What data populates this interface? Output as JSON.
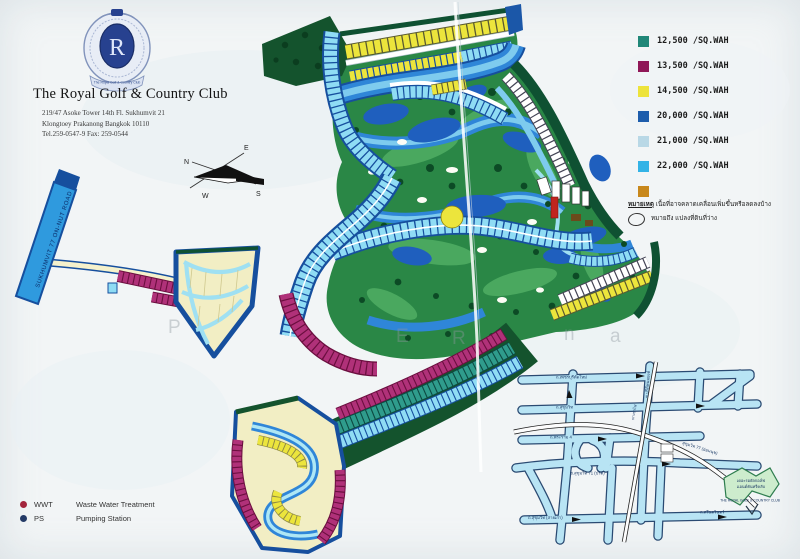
{
  "header": {
    "title": "The Royal Golf & Country Club",
    "address_line1": "219/47 Asoke Tower 14th Fl. Sukhumvit 21",
    "address_line2": "Klongtoey Prakanong Bangkok 10110",
    "address_line3": "Tel.259-0547-9 Fax: 259-0544",
    "crest_monogram": "R",
    "crest_ribbon": "The Royal Golf & Country Club"
  },
  "compass": {
    "n": "N",
    "e": "E",
    "w": "W",
    "s": "S"
  },
  "legend": {
    "items": [
      {
        "label": "12,500 /SQ.WAH",
        "color": "#208778"
      },
      {
        "label": "13,500 /SQ.WAH",
        "color": "#8f1757"
      },
      {
        "label": "14,500 /SQ.WAH",
        "color": "#ede33b"
      },
      {
        "label": "20,000 /SQ.WAH",
        "color": "#1d5dac"
      },
      {
        "label": "21,000 /SQ.WAH",
        "color": "#b9d8e6"
      },
      {
        "label": "22,000 /SQ.WAH",
        "color": "#33b3e6"
      },
      {
        "label": "",
        "color": "#c8881c"
      }
    ],
    "note_heading": "หมายเหตุ",
    "note_text": "เนื้อที่อาจคลาดเคลื่อนเพิ่มขึ้นหรือลดลงบ้าง",
    "vacant_note": "หมายถึง แปลงที่ดินที่ว่าง"
  },
  "facilities": {
    "wwt_abbr": "WWT",
    "wwt_label": "Waste Water Treatment",
    "wwt_color": "#a3253c",
    "ps_abbr": "PS",
    "ps_label": "Pumping Station",
    "ps_color": "#233a66"
  },
  "map": {
    "road_label": "SUKHUMVIT 77 ON-NUT ROAD",
    "watermark_letters": [
      "P",
      "E",
      "R",
      "n",
      "a"
    ]
  },
  "inset": {
    "road_top": "ถ.เพชรบุรีตัดใหม่",
    "road_2": "ถ.สุขุมวิท",
    "road_3": "ถ.พระราม 4",
    "road_4": "ซ.สุขุมวิท 71 (ปรีดี)",
    "road_soi": "ซ.ปรีดีพนมยงค์",
    "road_curve": "สุขุมวิท 77 (อ่อนนุช)",
    "road_old": "ถ.สุขุมวิท (สายเก่า)",
    "road_right": "ถ.ศรีนครินทร์",
    "rail": "ทางรถไฟ",
    "club_label_thai": "เดอะรอยัลกอล์ฟ",
    "club_label_thai2": "แอนด์คันทรีคลับ",
    "club_label_en": "THE ROYAL GOLF & COUNTRY CLUB"
  }
}
